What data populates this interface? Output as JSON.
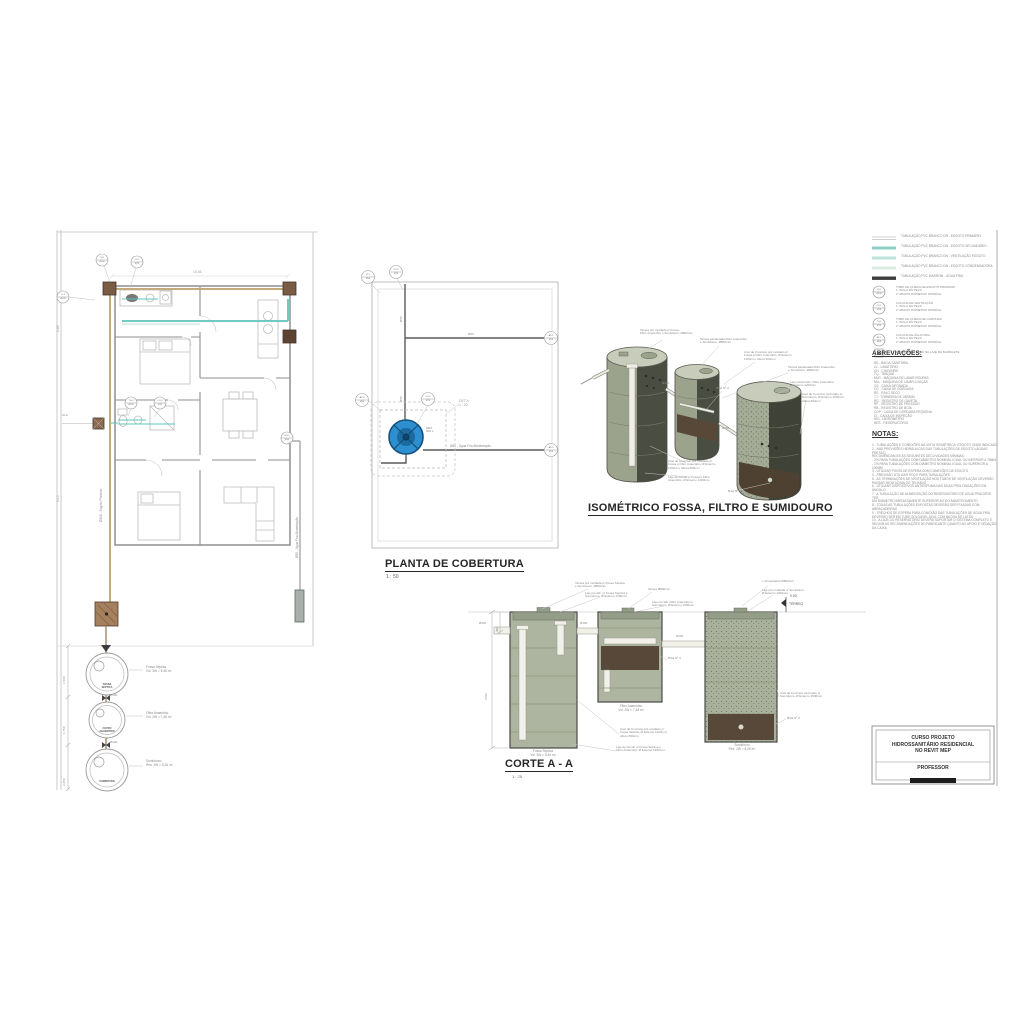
{
  "titles": {
    "roof": "PLANTA DE COBERTURA",
    "roof_scale": "1 : 50",
    "iso": "ISOMÉTRICO FOSSA, FILTRO E SUMIDOURO",
    "section": "CORTE A - A",
    "section_scale": "1 : 25"
  },
  "floor_plan": {
    "callouts": {
      "c1": "TQ-1\nØ100",
      "c2": "CV-1\nØ75",
      "c3": "CI-1\nØ100",
      "c4": "TQ-2\nØ100",
      "c5": "CV-2\nØ75",
      "c6": "RG-1\nØ50",
      "c7": "CI-2"
    },
    "dims": {
      "top": "10,45",
      "left1": "2,85",
      "left2": "6,10"
    },
    "pipe_labels": {
      "right_riser": "Ø50 - Água Fria Alimentação",
      "left_riser": "Ø100 - Esgoto Primário"
    },
    "chain": {
      "fossa": "Fossa Séptica\nVol. 3W = 5,46 m³",
      "filtro": "Filtro Anaeróbio\nVol. 2W = 7,48 m³",
      "sumidouro": "Sumidouro\nRes. 2W = 8,26 m³",
      "fossa_tag": "FOSSA\nSÉPTICA",
      "filtro_tag": "FILTRO\nANAERÓBIO",
      "sumidouro_tag": "SUMIDOURO",
      "pipe1": "Ø100",
      "pipe2": "Ø100",
      "dim1": "1,500",
      "dim2": "1,750",
      "dim3": "2,250"
    }
  },
  "roof_plan": {
    "callouts": {
      "c1": "VT-1\nØ50",
      "c2": "CV-1\nØ75",
      "c3": "AF-1\nØ25",
      "c4": "AF-2\nØ25",
      "c5": "AF-3\nØ20",
      "c6": "CV-2\nØ75"
    },
    "det": "DET A\n1 : 20",
    "riser1": "Ø50",
    "riser2": "Ø50",
    "pipe_top": "Ø50",
    "feed_label": "Ø50 - Água Fria Alimentação",
    "tank_label": "RES.\n500 L"
  },
  "isometric": {
    "ann": {
      "a1": "Tampa pré moldada p/ Fossa,\nFiltro Anaeróbio e Sumidouro, Ø800mm",
      "a2": "Tampa parafusada Filtro Anaeróbio\ne Sumidouro, Ø800mm",
      "a3": "Anel de Concreto pré moldado p/\nFossa e Filtro Anaeróbio, Ø Externo\n1100mm, Altura 500mm",
      "a4": "Tampa parafusada Filtro Anaeróbio\ne Sumidouro, Ø800mm",
      "a5": "Laje para fundo, Filtro Anaeróbio,\nØ Externo 1200mm",
      "a6": "Anel de Concreto perfurado p/\nSumidouro, Ø Externo 1500mm,\nAltura 500mm",
      "a7": "Anel de Concreto pré moldado p/\nFossa e Filtro Anaeróbio, Ø Externo\n1100mm, Altura 500mm",
      "a8": "Laje de Fundo p/ Fossa e Filtro\nAnaeróbio, Ø Externo 1200mm",
      "b1": "Brita Nº 4",
      "b2": "Brita Nº 4",
      "p1": "Ø100",
      "p2": "Ø100"
    }
  },
  "section": {
    "ann": {
      "a1": "Tampa pré moldada p/ Fossa Séptica\ne Sumidouro, Ø800mm",
      "a2": "Laje pré fab. p/ Fossa Séptica e\nSumidouro, Ø Externo 1300mm",
      "a3": "Tampa Ø800mm",
      "a4": "Laje pré fab. Filtro Anaeróbio e\nSumidouro, Ø Externo 1300mm",
      "a5": "+ Abraçadeira Ø800mm",
      "a6": "Laje pré moldada p/ Sumidouro,\nØ Externo 1300mm",
      "a7": "Anel de Concreto perfurado p/\nSumidouro, Ø Externo 1500mm",
      "a8": "Anel de Concreto pré moldado p/\nFossa Séptica, Ø Externo 1100mm,\nAltura 500mm",
      "a9": "Laje de Fundo p/ Fossa Séptica e\nFiltro Anaeróbio, Ø Externo 1300mm",
      "b1": "Brita Nº 4",
      "b2": "Brita Nº 4",
      "p1": "Ø100",
      "p2": "Ø100",
      "p3": "Ø100",
      "d1": "400",
      "d2": "2700"
    },
    "labels": {
      "fossa": "Fossa Séptica\nVol. 3W = 5,46 m³",
      "filtro": "Filtro Anaeróbio\nVol. 2W = 7,48 m³",
      "sumidouro": "Sumidouro\nRes. 2W = 8,26 m³"
    },
    "level": "0,00",
    "level_name": "TÉRREO"
  },
  "legend": {
    "lines": [
      "TUBULAÇÃO PVC BRANCO DN - ESGOTO PRIMÁRIO",
      "TUBULAÇÃO PVC BRANCO DN - ESGOTO SECUNDÁRIO",
      "TUBULAÇÃO PVC BRANCO DN - VENTILAÇÃO ESGOTO",
      "TUBULAÇÃO PVC BRANCO DN - ESGOTO CONDENSADORA",
      "TUBULAÇÃO PVC MARROM - ÁGUA FRIA"
    ],
    "symbols": [
      {
        "tag": "TQ-1\nØ100",
        "text": "TUBO DE QUEDA DE ESGOTO PRIMÁRIO\n1: SIGLA DA PEÇA\n2: ABAIXO DIÂMETRO NOMINAL"
      },
      {
        "tag": "CV-1\nØ75",
        "text": "COLUNA DE VENTILAÇÃO\n1: SIGLA DA PEÇA\n2: ABAIXO DIÂMETRO NOMINAL"
      },
      {
        "tag": "TQ-2\nØ75",
        "text": "TUBO DE QUEDA DE GORDURA\n1: SIGLA DA PEÇA\n2: ABAIXO DIÂMETRO NOMINAL"
      },
      {
        "tag": "AF-1\nØ25",
        "text": "COLUNA DE ÁGUA FRIA\n1: SIGLA DA PEÇA\n2: ABAIXO DIÂMETRO NOMINAL"
      },
      {
        "tag": "",
        "text": "POSIÇÃO DO TUBO NA LAJE DE BARRILETE"
      }
    ]
  },
  "abbreviations": {
    "heading": "ABREVIAÇÕES:",
    "body": "BS - BACIA SANITÁRIA\nLV - LAVATÓRIO\nCH - CHUVEIRO\nTQ - TANQUE\nMLR - MÁQUINA DE LAVAR ROUPAS\nMLL - MÁQUINA DE LAVAR LOUÇAS\nCS - CAIXA SIFONADA\nCG - CAIXA DE GORDURA\nRS - RALO SECO\nTJ - TORNEIRA DE JARDIM\nRG - REGISTRO DE GAVETA\nRP - REGISTRO DE PRESSÃO\nRB - REGISTRO DE BOIA\nCGP - CAIXA DE GORDURA PEQUENA\nCI - CAIXA DE INSPEÇÃO\nHID - HIDRÔMETRO\nRES - RESERVATÓRIO"
  },
  "notes": {
    "heading": "NOTAS:",
    "body": "1 - TUBULAÇÕES E CONEXÕES NA VISTA ISOMÉTRICA: ESGOTO ONDE INDICADO\n2 - NAS PREVISÕES HIDRÁULICAS DAS TUBULAÇÕES DE ESGOTO (ÁGUAS PRETAS)\nRECOMENDAM-SE AS SEGUINTES DECLIVIDADES MÍNIMAS:\n- 2% PARA TUBULAÇÕES COM DIÂMETRO NOMINAL IGUAL OU INFERIOR A 75MM\n- 1% PARA TUBULAÇÕES COM DIÂMETRO NOMINAL IGUAL OU SUPERIOR A 100MM\n3 - UTILIZAR PONTA DE ESPERA COM CONEXÕES DE ESGOTO\n4 - PREVISÃO UTILIZAR POÇO PARA TUBULAÇÕES\n5 - AS TERMINAÇÕES DE VENTILAÇÃO NOS TUBOS DE VENTILAÇÃO DEVERÃO\nPASSAR 30CM ACIMA DO TELHADO\n6 - UTILIZAR DISPOSITIVOS ANTIESPUMA NAS DUAS PROLONGAÇÕES EM ÂNGULO\n7 - A TUBULAÇÃO DE ALIMENTAÇÃO DO RESERVATÓRIO DE ÁGUA FRIA DEVE TER\nUM DIÂMETRO IMEDIATAMENTE SUPERIOR AO DO ABASTECIMENTO\n8 - TODAS AS TUBULAÇÕES EXPOSTAS DEVERÃO SER FIXADAS COM ABRAÇADEIRAS\n9 - TRECHOS DE ESPERA PARA CONEXÃO DAS TUBULAÇÕES DE ÁGUA FRIA\nDEVERÃO SER EM TUBO SOLDÁVEL AZUL COM BUCHA DE LATÃO\n10 - A LAJE DO RESERVATÓRIO DEVERÁ SUPORTAR O SISTEMA COMPLETO E\nSEGUIR AS RECOMENDAÇÕES DO FABRICANTE QUANTO AO APOIO E VEDAÇÃO\nDA CAIXA"
  },
  "title_block": {
    "course": "CURSO PROJETO\nHIDROSSANITÁRIO RESIDENCIAL\nNO REVIT MEP",
    "professor_label": "PROFESSOR",
    "professor_name": "██████████ ███"
  }
}
